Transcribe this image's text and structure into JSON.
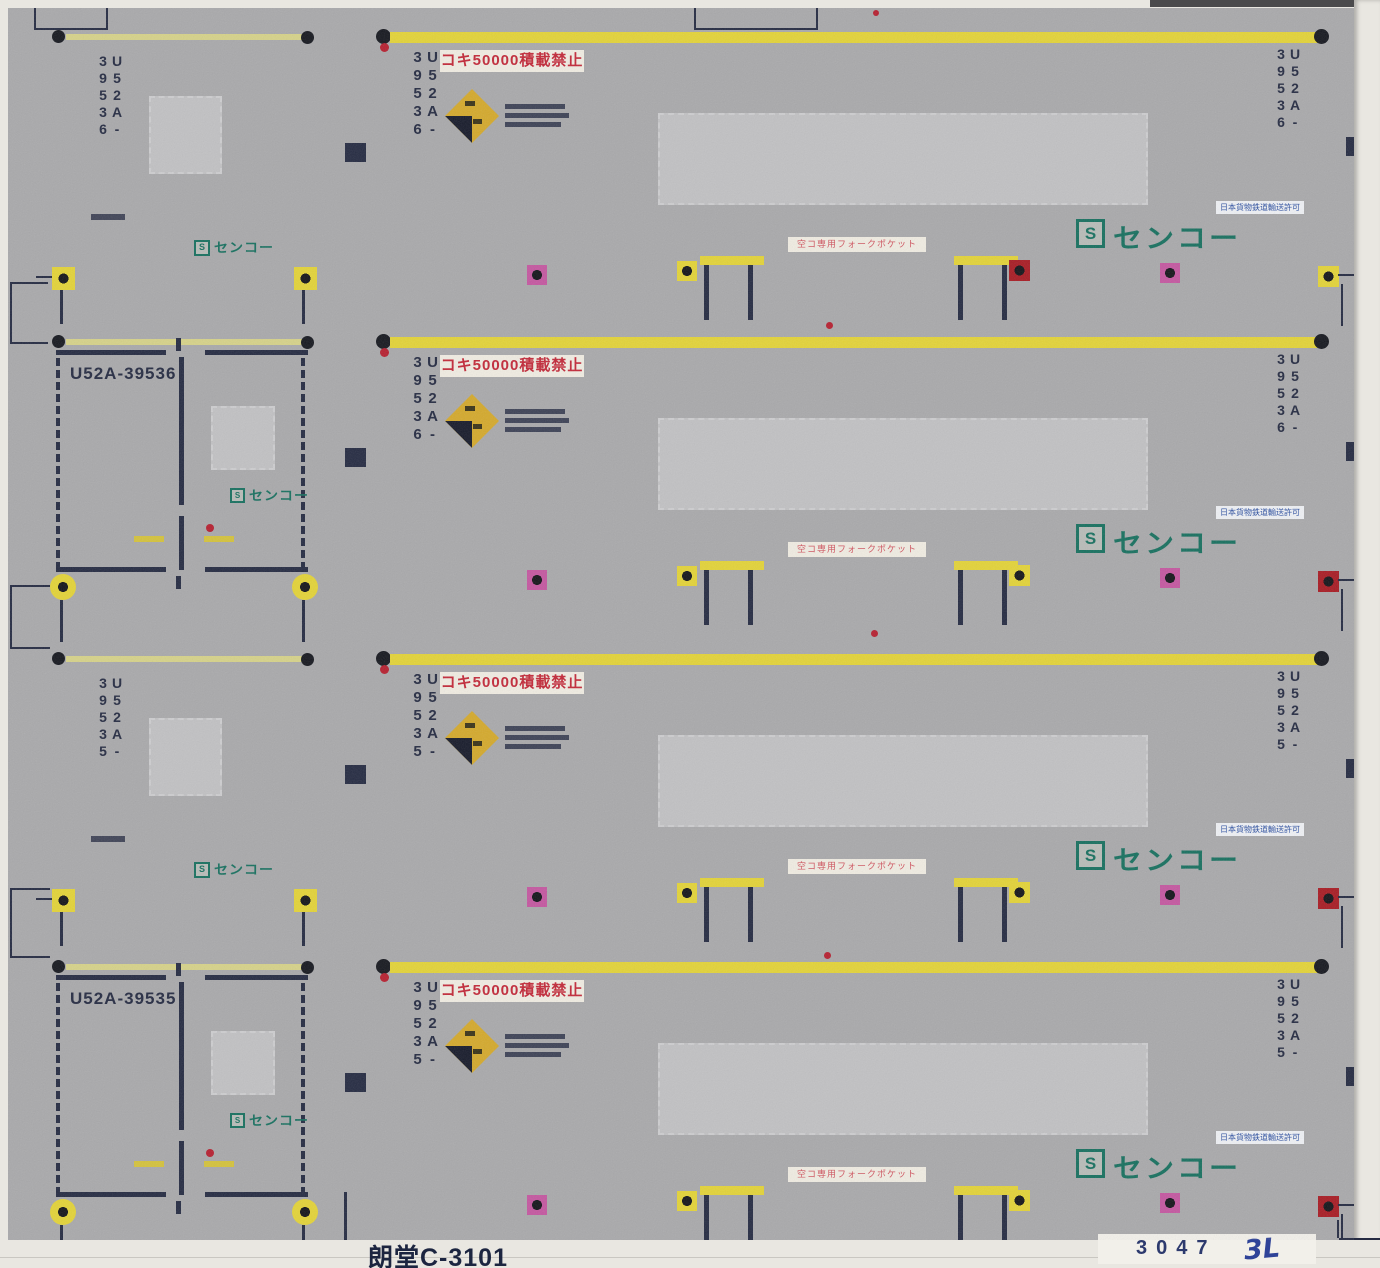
{
  "sheet": {
    "product_code": "朗堂C-3101",
    "stamp": {
      "printed": "3047",
      "handwritten": "3L"
    },
    "labels": {
      "no_load": "コキ50000積載禁止",
      "fork_pocket": "空コ専用フォークポケット",
      "approval": "日本貨物鉄道輸送許可",
      "logo_text": "センコー",
      "logo_mark": "S"
    },
    "colors": {
      "background_gray": "#a9a9ab",
      "bar_yellow": "#e3d338",
      "bar_pale_yellow": "#d6d289",
      "ink_navy": "#252b42",
      "label_red": "#c22838",
      "logo_green": "#17705f",
      "magenta": "#c457a0",
      "dark_red": "#a81c24",
      "diamond_gold": "#d4a92c",
      "patch_gray": "#c1c1c3",
      "paper_white": "#e9e7e1",
      "hand_ink_blue": "#2f4398"
    },
    "panels": [
      {
        "serial": "U52A-39536",
        "left_type": "roof",
        "fork_accent": "#a81c24",
        "corner_accent": "#e3d338"
      },
      {
        "serial": "U52A-39536",
        "left_type": "door",
        "fork_accent": "#e3d338",
        "corner_accent": "#a81c24"
      },
      {
        "serial": "U52A-39535",
        "left_type": "roof",
        "fork_accent": "#e3d338",
        "corner_accent": "#a81c24"
      },
      {
        "serial": "U52A-39535",
        "left_type": "door",
        "fork_accent": "#e3d338",
        "corner_accent": "#a81c24"
      }
    ]
  }
}
